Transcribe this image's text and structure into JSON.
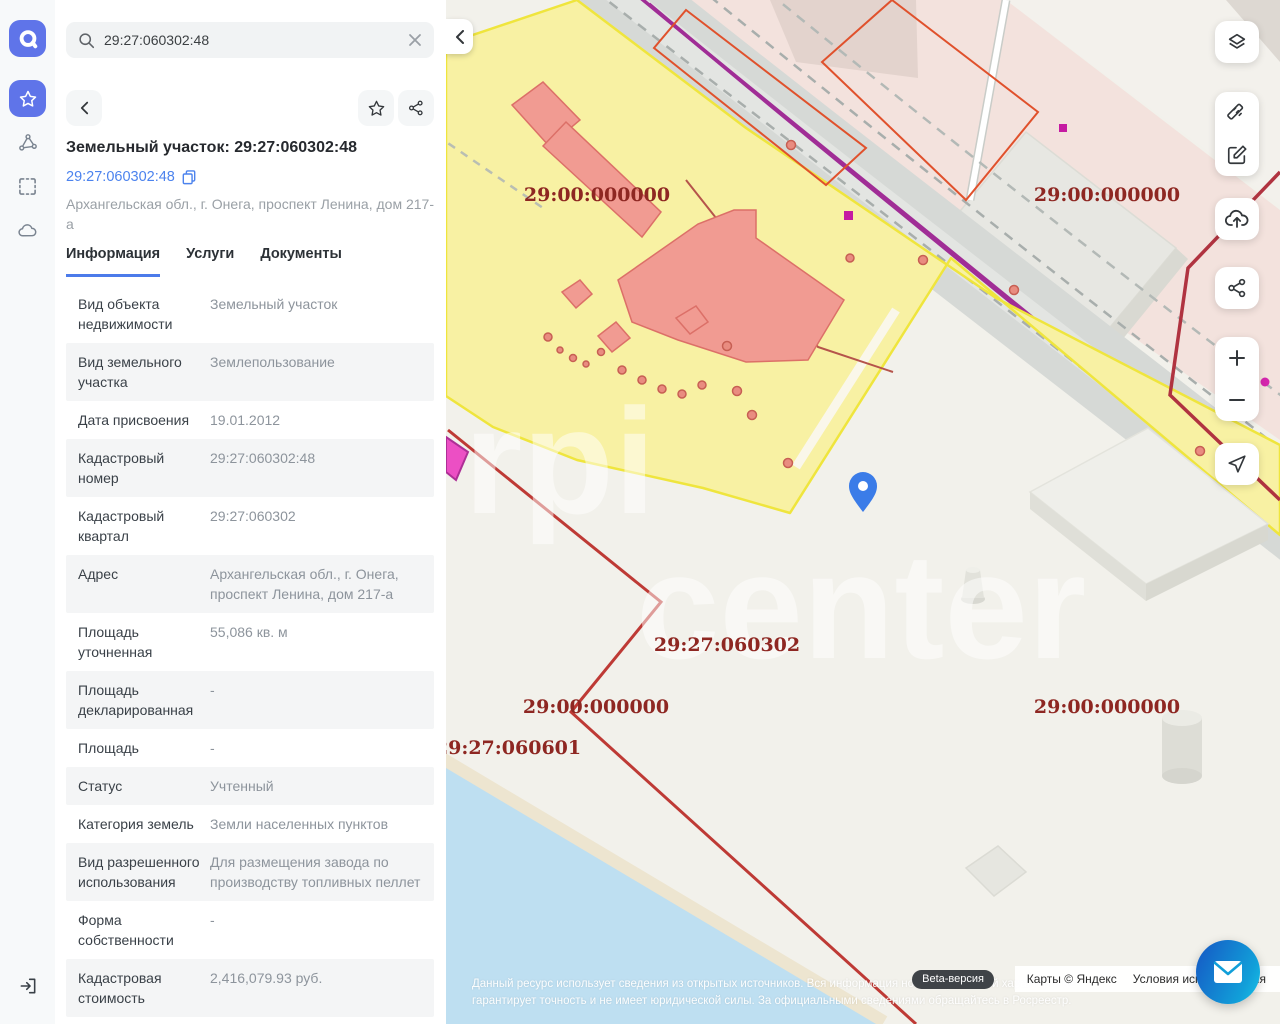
{
  "colors": {
    "accent_blue": "#5f74e9",
    "link_blue": "#4c83ee",
    "parcel_yellow": "#f8f1a3",
    "building_salmon": "#f19b92",
    "label_red": "#8e2722",
    "boundary_red": "#be3a35",
    "magenta": "#ec4fc4",
    "water_blue": "#bedff1",
    "chat_gradient": [
      "#1565c8",
      "#17c4e8"
    ]
  },
  "sidebar": {
    "logo": "a",
    "items": [
      {
        "icon": "star-icon",
        "active": true
      },
      {
        "icon": "polygon-nodes-icon",
        "active": false
      },
      {
        "icon": "select-area-icon",
        "active": false
      },
      {
        "icon": "cloud-icon",
        "active": false
      }
    ],
    "bottom_icon": "sign-in-icon"
  },
  "search": {
    "value": "29:27:060302:48"
  },
  "panel": {
    "title": "Земельный участок: 29:27:060302:48",
    "link": "29:27:060302:48",
    "address": "Архангельская обл., г. Онега, проспект Ленина, дом 217-а",
    "tabs": [
      {
        "label": "Информация",
        "active": true
      },
      {
        "label": "Услуги",
        "active": false
      },
      {
        "label": "Документы",
        "active": false
      }
    ],
    "rows": [
      {
        "label": "Вид объекта недвижимости",
        "value": "Земельный участок"
      },
      {
        "label": "Вид земельного участка",
        "value": "Землепользование"
      },
      {
        "label": "Дата присвоения",
        "value": "19.01.2012"
      },
      {
        "label": "Кадастровый номер",
        "value": "29:27:060302:48"
      },
      {
        "label": "Кадастровый квартал",
        "value": "29:27:060302"
      },
      {
        "label": "Адрес",
        "value": "Архангельская обл., г. Онега, проспект Ленина, дом 217-а"
      },
      {
        "label": "Площадь уточненная",
        "value": "55,086 кв. м"
      },
      {
        "label": "Площадь декларированная",
        "value": "-"
      },
      {
        "label": "Площадь",
        "value": "-"
      },
      {
        "label": "Статус",
        "value": "Учтенный"
      },
      {
        "label": "Категория земель",
        "value": "Земли населенных пунктов"
      },
      {
        "label": "Вид разрешенного использования",
        "value": "Для размещения завода по производству топливных пеллет"
      },
      {
        "label": "Форма собственности",
        "value": "-"
      },
      {
        "label": "Кадастровая стоимость",
        "value": "2,416,079.93 руб."
      }
    ]
  },
  "map": {
    "labels": [
      {
        "text": "29:00:000000"
      },
      {
        "text": "29:00:000000"
      },
      {
        "text": "29:27:060302"
      },
      {
        "text": "29:00:000000"
      },
      {
        "text": "29:27:060601"
      },
      {
        "text": "29:00:000000"
      }
    ],
    "watermark_a": "rpi",
    "watermark_b": "center",
    "controls": [
      "layers-icon",
      "ruler-icon",
      "edit-icon",
      "upload-cloud-icon",
      "share-icon",
      "zoom-in",
      "zoom-out",
      "locate-icon"
    ],
    "attribution": {
      "beta": "Beta-версия",
      "copyright": "Карты © Яндекс",
      "terms": "Условия использования"
    },
    "disclaimer_line1": "Данный ресурс использует сведения из открытых источников. Вся информация носит справочный характер и не",
    "disclaimer_line2": "гарантирует точность и не имеет юридической силы. За официальными сведениями обращайтесь в Росреестр."
  }
}
